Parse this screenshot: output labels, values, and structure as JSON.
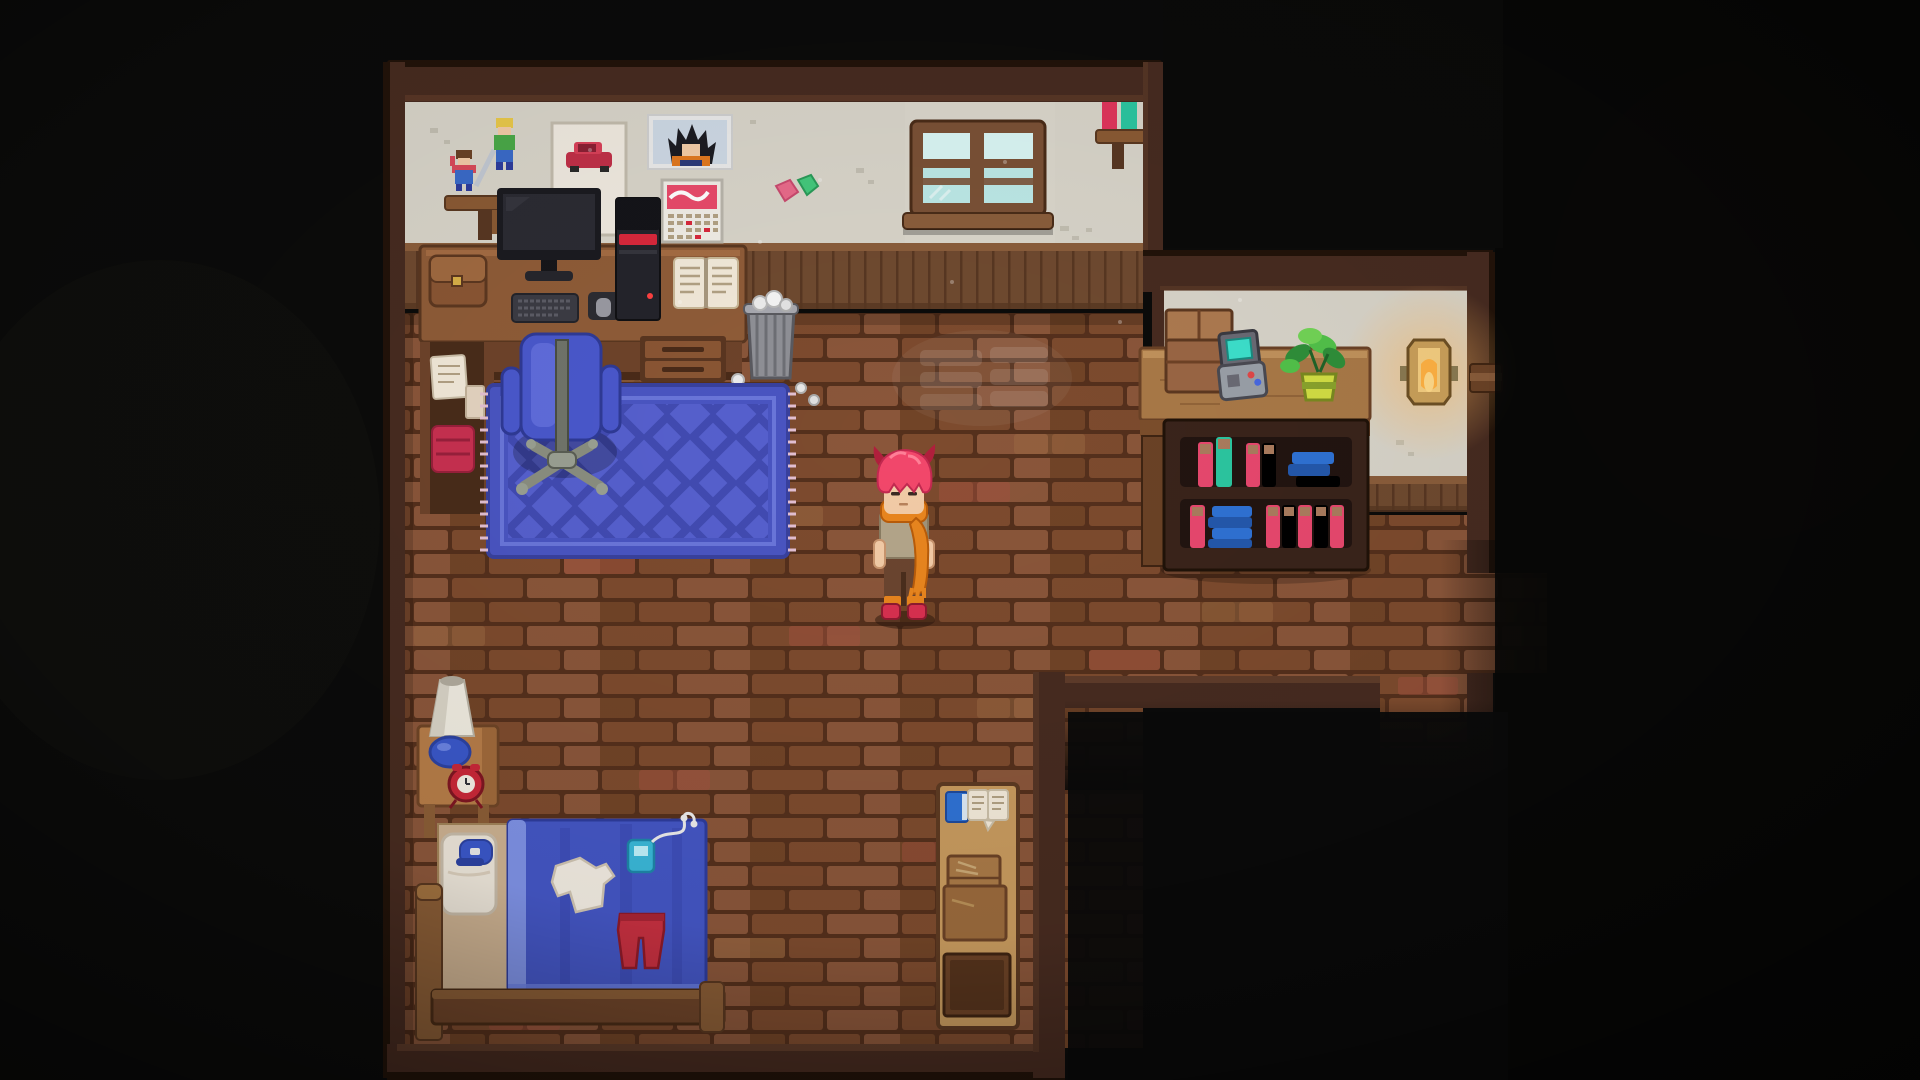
{
  "scene": {
    "game_view": "top-down pixel-art bedroom",
    "player": {
      "state": "standing-idle",
      "facing": "down"
    }
  },
  "colors": {
    "bgOutside": "#0b0b0a",
    "wallBand": "#472b20",
    "wallBandDark": "#221309",
    "wallBandLip": "#5f3c2a",
    "plaster": "#d8d4c9",
    "plasterSpeck": "#c2beb1",
    "wainscotTrim": "#8a5d3b",
    "wainscot": "#6f4a30",
    "wainscotLine": "#583722",
    "mortar": "#55301c",
    "brickA": "#7d4b2e",
    "brickB": "#8a563a",
    "brickC": "#714427",
    "brickRed": "#a3523e",
    "brickLight": "#9c6a42",
    "rugBase": "#4a55c2",
    "rugDark": "#39419e",
    "rugInner": "#6a76da",
    "rugFringe": "#e3bfd2",
    "chairBlue": "#4a58cc",
    "chairBlueHi": "#6a78e4",
    "chairBase": "#9aa092",
    "deskTop": "#8f5c38",
    "deskFront": "#6e432a",
    "deskDark": "#4a2b18",
    "drawerFace": "#8a5634",
    "monitorBezel": "#1b1b20",
    "monitorScreen": "#2b2b33",
    "towerBody": "#24242b",
    "towerTop": "#141419",
    "towerStripe": "#d8283c",
    "paperWhite": "#f2e9d9",
    "paperInk": "#b2a184",
    "satchel": "#8a5634",
    "satchelFlap": "#a06a40",
    "clothRed": "#c83050",
    "trashGray": "#8f9096",
    "trashRib": "#6e6f75",
    "trashRim": "#a8a9b0",
    "windowFrame": "#7a5136",
    "windowGlass": "#bce8e6",
    "windowGlassHi": "#d9f5f3",
    "windowSill": "#8a5d3b",
    "shelfBoard": "#8a5a34",
    "bookRed": "#e0355c",
    "bookTeal": "#2cc6a0",
    "bookPink": "#e8486e",
    "bookCrimson": "#c9２e52",
    "bookBlue": "#2f72d4",
    "bookBlueDark": "#2458ac",
    "bookPageTan": "#ab7c5e",
    "counterTop": "#a97947",
    "counterHi": "#c1925c",
    "counterFront": "#7c4e2c",
    "caseFrame": "#3a241b",
    "caseCavity": "#221410",
    "boxBrown": "#9a6644",
    "boxLight": "#ad7a50",
    "handheldGray": "#9aa0a8",
    "handheldDark": "#6a6a74",
    "handheldScreen": "#3ce0cc",
    "plantDark": "#2f8f3a",
    "plantMid": "#52c24a",
    "plantLight": "#72d456",
    "potLight": "#d2de44",
    "potDark": "#8aa32c",
    "lampGold": "#caa05a",
    "lampInner": "#f4cd80",
    "lampCore": "#ffb143",
    "skin": "#f2cba6",
    "hairPink": "#f2476b",
    "hairHorn": "#b01f3c",
    "shirtTan": "#b3a58a",
    "shirtShade": "#9c8e74",
    "scarfOrange": "#e8851e",
    "scarfDark": "#b85c0a",
    "pantsBrown": "#6b4530",
    "shoeRed": "#d83050",
    "bedWood": "#8a5d36",
    "bedWoodDark": "#6e4429",
    "sheetTan": "#cbb090",
    "pillowWhite": "#ebe4d8",
    "blanketBlue": "#4456c4",
    "blanketLight": "#7e91e4",
    "blanketFold": "#3a4ab2",
    "capBlue": "#3a57c8",
    "teeWhite": "#f1ebe1",
    "pantsRed": "#c63040",
    "playerTeal": "#3ab8d8",
    "nightstand": "#b57c48",
    "clockRed": "#c82838",
    "lampShadeWhite": "#eeeadf",
    "lampShadeShade": "#d7d2c5",
    "lampBaseBlue": "#3a57c8",
    "writingDeskTop": "#c79a5e",
    "crateBrown": "#a97947",
    "crateBrown2": "#9a6a3c",
    "drawerDark": "#6b4226",
    "drawerDarker": "#55331c"
  },
  "objects": [
    {
      "name": "player-character",
      "detail": "red-pink hair with horn tufts, orange scarf, tan shirt"
    },
    {
      "name": "figurine-shelf",
      "detail": "two action figurines on wall shelf"
    },
    {
      "name": "car-poster"
    },
    {
      "name": "anime-poster",
      "detail": "spiky-haired fighter in orange gi"
    },
    {
      "name": "wall-calendar"
    },
    {
      "name": "wall-stickers"
    },
    {
      "name": "window",
      "panes": 4
    },
    {
      "name": "wall-book-shelf",
      "books": [
        "red",
        "teal"
      ]
    },
    {
      "name": "computer-desk"
    },
    {
      "name": "monitor"
    },
    {
      "name": "keyboard"
    },
    {
      "name": "mouse"
    },
    {
      "name": "pc-tower",
      "detail": "black tower with red stripe"
    },
    {
      "name": "open-book"
    },
    {
      "name": "satchel"
    },
    {
      "name": "papers"
    },
    {
      "name": "red-cloth"
    },
    {
      "name": "desk-drawers"
    },
    {
      "name": "trash-can",
      "detail": "crumpled papers inside and on floor"
    },
    {
      "name": "office-chair",
      "color": "blue"
    },
    {
      "name": "area-rug",
      "detail": "blue diamond lattice with fringe"
    },
    {
      "name": "alcove-counter"
    },
    {
      "name": "cardboard-box"
    },
    {
      "name": "handheld-console",
      "detail": "teal screen"
    },
    {
      "name": "potted-plant"
    },
    {
      "name": "bookcase",
      "shelves": 2
    },
    {
      "name": "wall-lantern",
      "state": "lit"
    },
    {
      "name": "door-bracket"
    },
    {
      "name": "corridor-exit"
    },
    {
      "name": "bed",
      "detail": "blue blanket, white tee, red pants, music player with earbuds, cap on pillow"
    },
    {
      "name": "nightstand"
    },
    {
      "name": "table-lamp"
    },
    {
      "name": "alarm-clock"
    },
    {
      "name": "writing-desk",
      "detail": "blue book, open letter, crates, dark drawer"
    }
  ]
}
